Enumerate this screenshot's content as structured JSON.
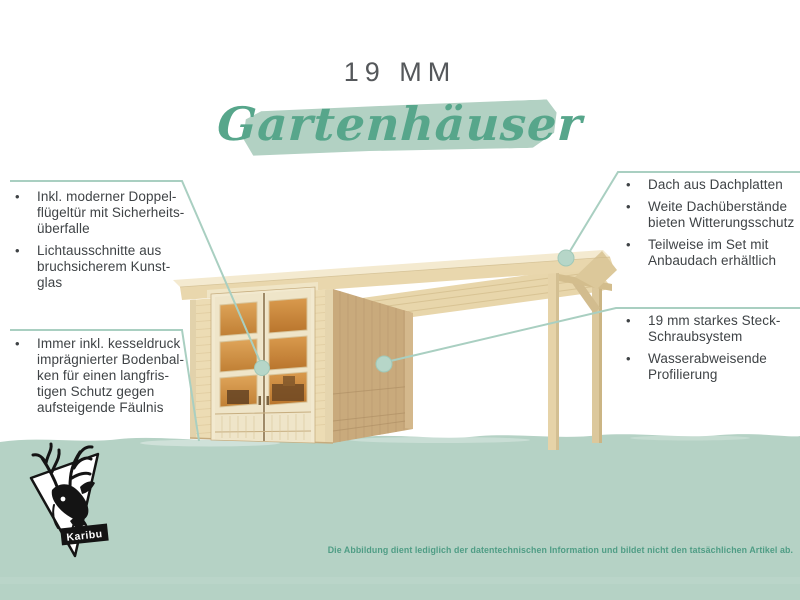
{
  "header": {
    "size_label": "19 MM",
    "script_title": "Gartenhäuser"
  },
  "ui": {
    "bullet_glyph": "•"
  },
  "callouts": {
    "top_left": {
      "items": [
        "Inkl. moderner Doppel-\nflügeltür mit Sicherheits-\nüberfalle",
        "Lichtausschnitte aus\nbruchsicherem Kunst-\nglas"
      ]
    },
    "bottom_left": {
      "items": [
        "Immer inkl. kesseldruck\nimprägnierter Bodenbal-\nken für einen langfris-\ntigen Schutz gegen\naufsteigende Fäulnis"
      ]
    },
    "top_right": {
      "items": [
        "Dach aus Dachplatten",
        "Weite Dachüberstände\nbieten Witterungsschutz",
        "Teilweise im Set mit\nAnbaudach erhältlich"
      ]
    },
    "bottom_right": {
      "items": [
        "19 mm starkes Steck-\nSchraubsystem",
        "Wasserabweisende\nProfilierung"
      ]
    }
  },
  "footer": {
    "brand": "Karibu",
    "disclaimer": "Die Abbildung dient lediglich der datentechnischen Information und bildet nicht den tatsächlichen Artikel ab."
  },
  "colors": {
    "band_green": "#b5d2c5",
    "brush_green": "#b2d1c3",
    "accent_line": "#a9cfc1",
    "script_green": "#57a68b",
    "body_text": "#3f4346",
    "title_text": "#55585b",
    "disclaimer_text": "#4f9d85",
    "wood_light": "#ecdcb4",
    "wood_shade": "#c9aa7c",
    "window_amber": "#cf9040"
  }
}
